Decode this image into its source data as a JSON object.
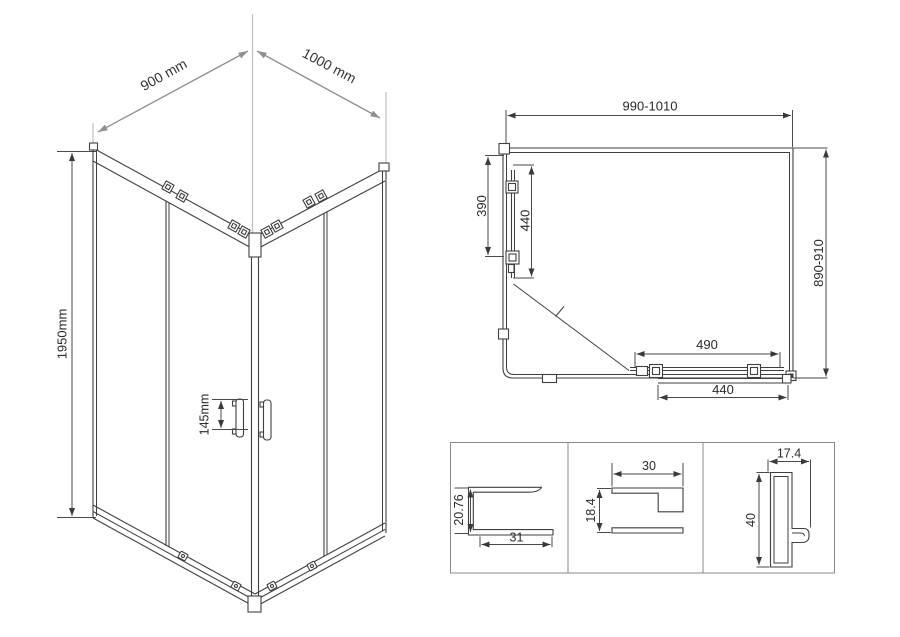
{
  "views": {
    "perspective": {
      "width_label": "900 mm",
      "depth_label": "1000 mm",
      "height_label": "1950mm",
      "handle_spacing_label": "145mm"
    },
    "plan": {
      "overall_width": "990-1010",
      "overall_depth": "890-910",
      "side_fixed_panel": "390",
      "side_door": "440",
      "front_door": "490",
      "front_fixed_panel": "440"
    },
    "profiles": [
      {
        "name": "bottom-rail-profile",
        "height": "20.76",
        "width": "31"
      },
      {
        "name": "wall-profile",
        "width": "30",
        "height": "18.4"
      },
      {
        "name": "vertical-post-profile",
        "width": "17.4",
        "height": "40"
      }
    ]
  },
  "colors": {
    "background": "#ffffff",
    "drawing_line": "#3f3f3f",
    "dimension_arrow": "#8f8f8f",
    "text": "#2a2a2a"
  }
}
